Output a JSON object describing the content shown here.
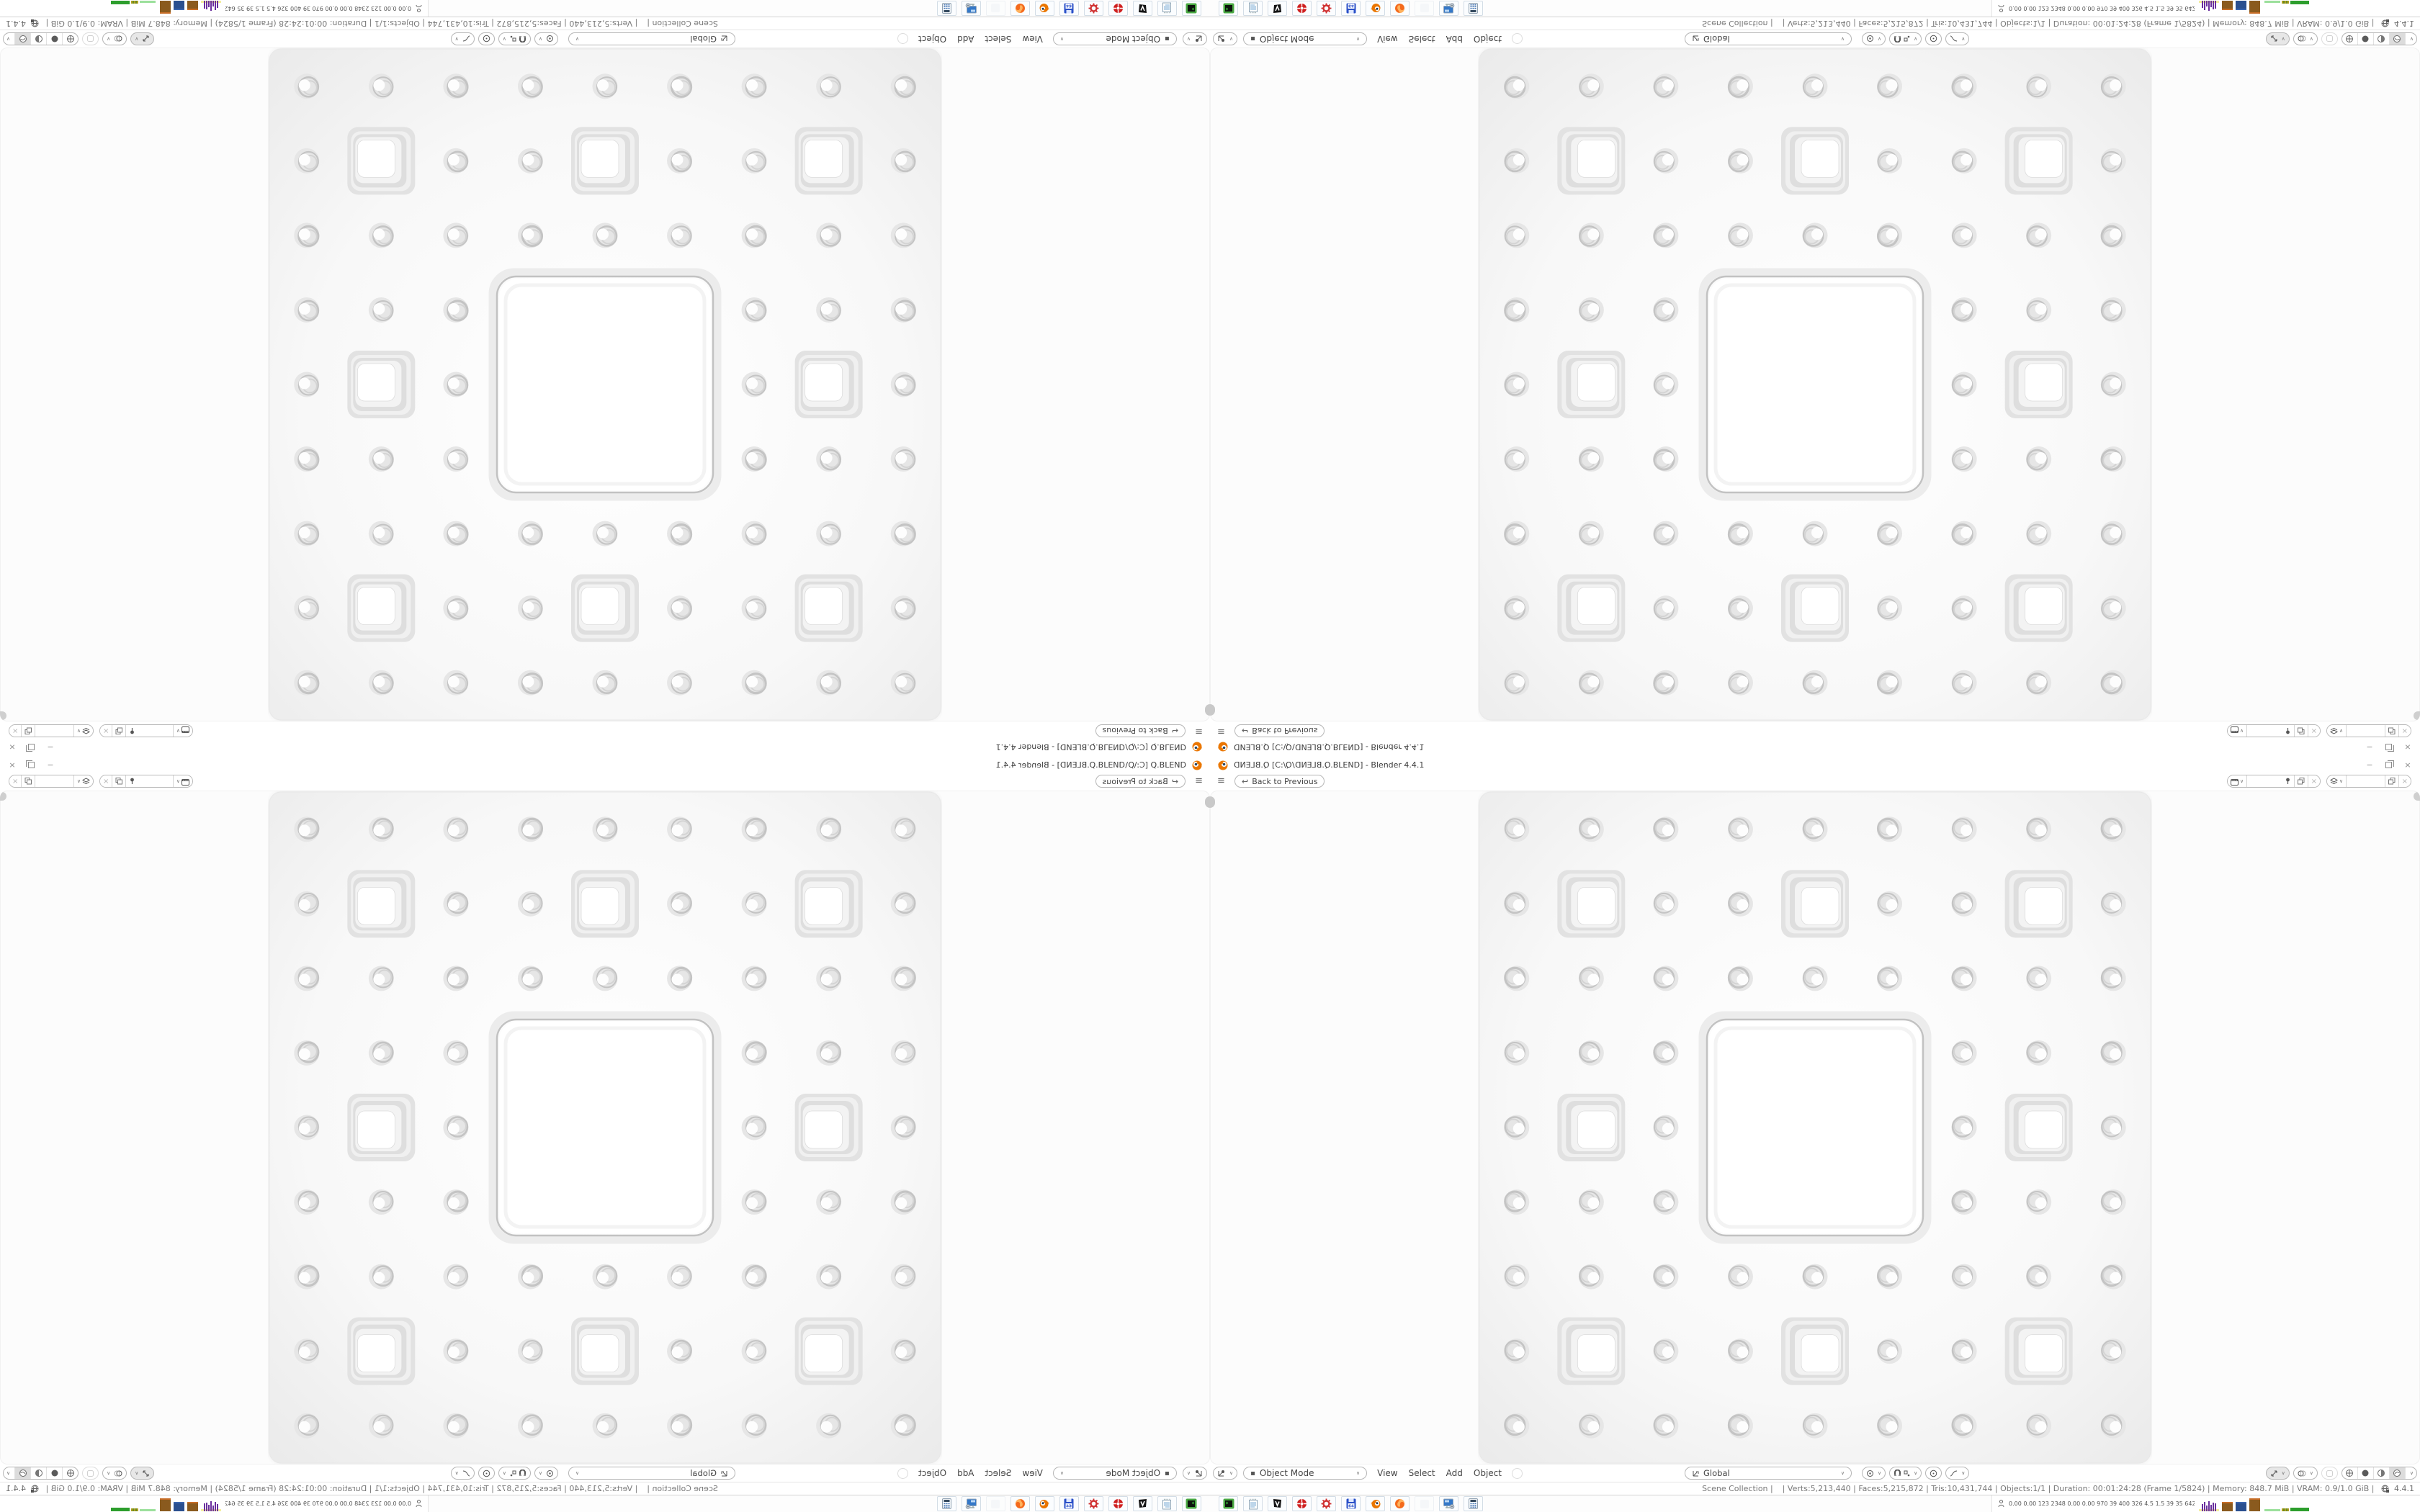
{
  "window": {
    "title": {
      "file_mirrored": "Q.BLEND",
      "open_bracket": " [C:\\",
      "dir_mirrored": "Q",
      "backslash": "\\",
      "file2_mirrored": "Q.BLEND",
      "tail": ".BLEND] - Blender 4.4.1"
    },
    "controls": {
      "minimize": "−",
      "close": "×"
    }
  },
  "topbar": {
    "menu_icon": "≡",
    "back_arrow": "↩",
    "back_label": "Back to Previous"
  },
  "viewport_header": {
    "mode_label": "Object Mode",
    "mode_icon": "▪",
    "menus": [
      "View",
      "Select",
      "Add",
      "Object"
    ],
    "orientation_label": "Global",
    "chevron": "∨"
  },
  "status": {
    "left": "Scene Collection | ",
    "stats": " | Verts:5,213,440 | Faces:5,215,872 | Tris:10,431,744 | Objects:1/1 | Duration: 00:01:24:28 (Frame 1/5824) | Memory: 848.7 MiB | VRAM: 0.9/1.0 GiB | ",
    "version": "4.4.1"
  },
  "taskbar": {
    "launchers": [
      "terminal",
      "notepad",
      "media-player",
      "red-badge",
      "red-gear",
      "floppy-64",
      "blender",
      "firefox",
      "ghost",
      "display-settings",
      "calculator"
    ],
    "monitor_values": "0.00 0.00 123 2348 0.00 0.00 970 39 400 326 4.5 1.5 39 35 6427/2961"
  },
  "colors": {
    "blender_orange": "#ea7600",
    "ui_text": "#454545",
    "status_text": "#787878",
    "sponge_ring": "#c4c4c4",
    "monitor_purple": "#6a2f9e",
    "monitor_brown": "#8a5a1e",
    "monitor_blue": "#2a4f8f",
    "monitor_green": "#2d9e2d"
  }
}
